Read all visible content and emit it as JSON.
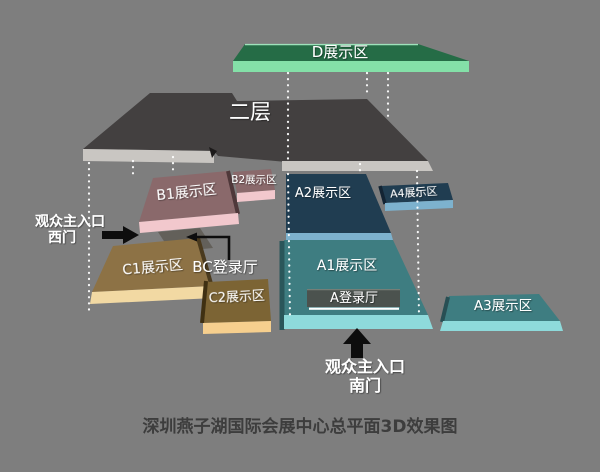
{
  "caption": "深圳燕子湖国际会展中心总平面3D效果图",
  "areas": {
    "d": "D展示区",
    "second_floor": "二层",
    "b1": "B1展示区",
    "b2": "B2展示区",
    "a1": "A1展示区",
    "a2": "A2展示区",
    "a3": "A3展示区",
    "a4": "A4展示区",
    "c1": "C1展示区",
    "c2": "C2展示区",
    "a_lobby": "A登录厅",
    "bc_lobby": "BC登录厅"
  },
  "entrances": {
    "west": {
      "line1": "观众主入口",
      "line2": "西门"
    },
    "south": {
      "line1": "观众主入口",
      "line2": "南门"
    }
  },
  "colors": {
    "background": "#7e7e7e",
    "d_top": "#256c46",
    "d_front": "#84e0a8",
    "floor2_top": "#434040",
    "floor2_front": "#c9c6c2",
    "b_top": "#8a696b",
    "b_front": "#f2c8cd",
    "a_top": "#203d51",
    "a_front": "#7db2ce",
    "a1_top": "#3e7d81",
    "a1_front": "#8edadb",
    "c1_top": "#8d7245",
    "c1_front": "#f2d9a3",
    "c2_top": "#7c6434",
    "c2_front": "#f6cf8e",
    "lobby_bar": "#4b524e",
    "ramp": "#63605a",
    "arrow": "#0d0d0d",
    "label": "#ffffff",
    "caption_color": "#3d3d3d"
  }
}
